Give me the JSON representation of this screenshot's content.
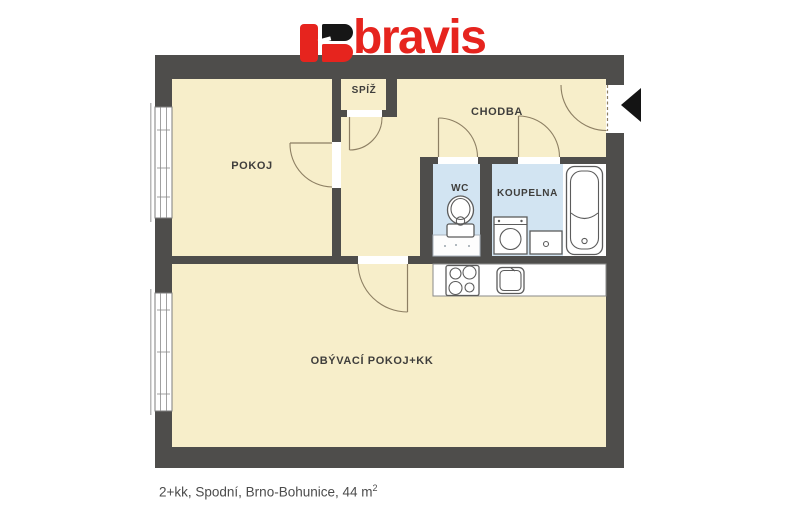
{
  "logo": {
    "brand": "bravis"
  },
  "rooms": {
    "pokoj": {
      "label": "POKOJ"
    },
    "spiz": {
      "label": "SPÍŽ"
    },
    "chodba": {
      "label": "CHODBA"
    },
    "wc": {
      "label": "WC"
    },
    "koupelna": {
      "label": "KOUPELNA"
    },
    "obyvaci": {
      "label": "OBÝVACÍ POKOJ+KK"
    }
  },
  "caption": {
    "text": "2+kk, Spodní, Brno-Bohunice, 44 m",
    "sup": "2"
  },
  "colors": {
    "accent": "#e6241e",
    "wall": "#4e4d4b",
    "floor": "#f7eeca",
    "wet": "#d2e4f2",
    "arc": "#8d7f63",
    "label": "#3f3e3c",
    "caption": "#4c4c4c"
  }
}
